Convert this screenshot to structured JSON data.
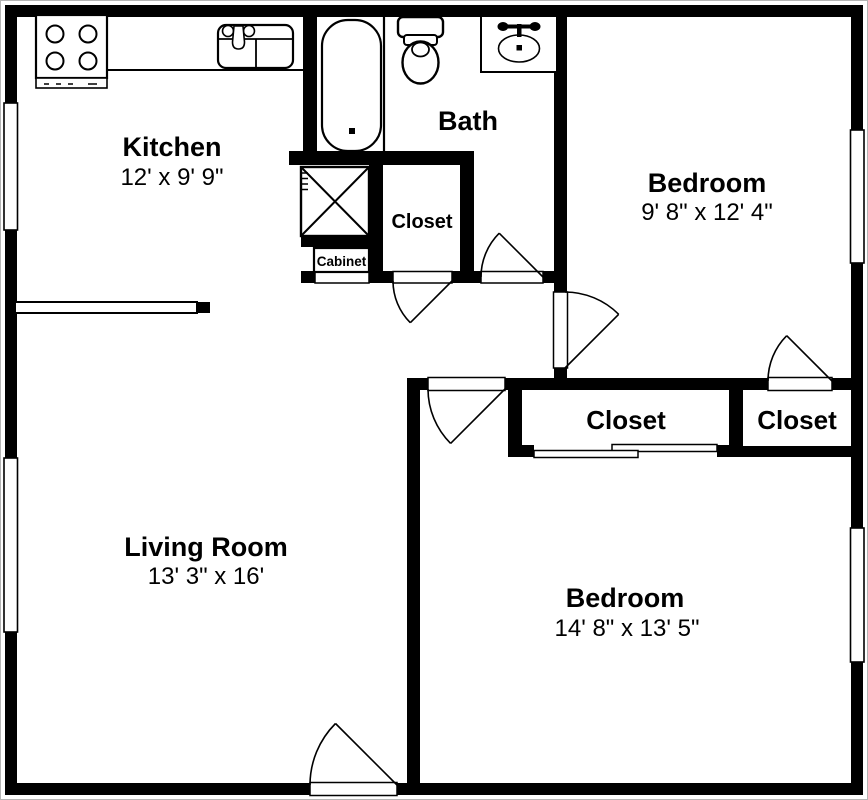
{
  "floor_plan": {
    "rooms": {
      "kitchen": {
        "name": "Kitchen",
        "dimensions": "12' x 9' 9\""
      },
      "bath": {
        "name": "Bath"
      },
      "bedroom_top": {
        "name": "Bedroom",
        "dimensions": "9' 8\" x 12' 4\""
      },
      "bedroom_bottom": {
        "name": "Bedroom",
        "dimensions": "14' 8\" x 13' 5\""
      },
      "living_room": {
        "name": "Living Room",
        "dimensions": "13' 3\" x 16'"
      },
      "hall_closet": {
        "name": "Closet"
      },
      "bedroom_bottom_closet": {
        "name": "Closet"
      },
      "bedroom_top_closet": {
        "name": "Closet"
      },
      "cabinet": {
        "name": "Cabinet"
      }
    },
    "colors": {
      "wall": "#000000",
      "background": "#ffffff",
      "frame_border": "#b4b4b4"
    },
    "icons": [
      "stove-icon",
      "kitchen-sink-icon",
      "bathtub-icon",
      "toilet-icon",
      "bathroom-sink-icon",
      "appliance-xbox-icon"
    ]
  }
}
